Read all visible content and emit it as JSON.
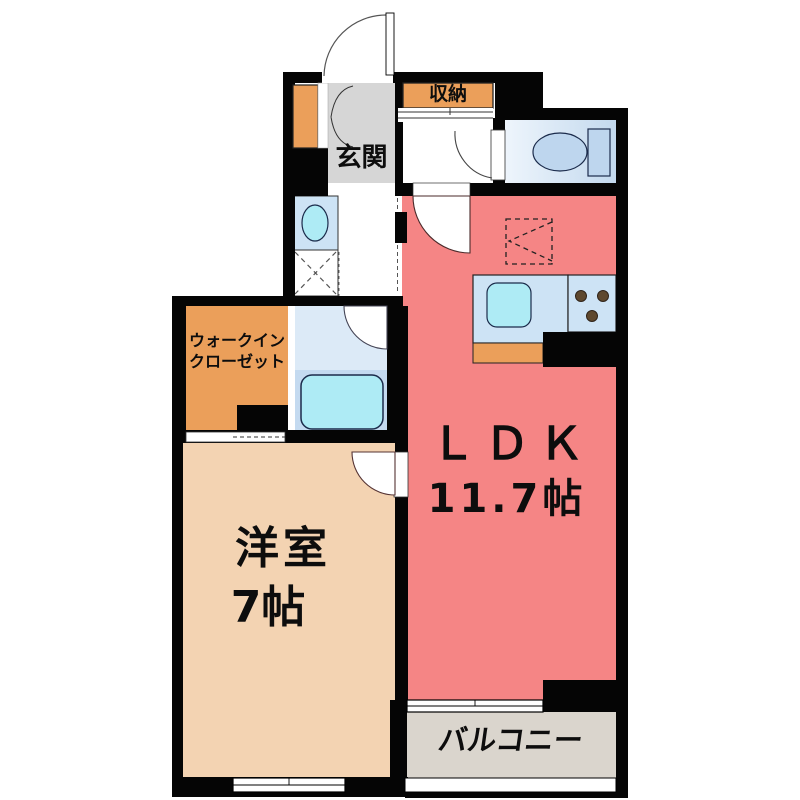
{
  "rooms": {
    "genkan_label": "玄関",
    "storage_label": "収納",
    "walkin_label_line1": "ウォークイン",
    "walkin_label_line2": "クローゼット",
    "ldk_label": "ＬＤＫ",
    "ldk_size": "11.7帖",
    "western_label": "洋室",
    "western_size": "7帖",
    "balcony_label": "バルコニー"
  },
  "colors": {
    "wall": "#050505",
    "ldk_fill": "#f58585",
    "western_fill": "#f3d3b2",
    "closet_fill": "#eb9f5a",
    "genkan_fill": "#d6d6d6",
    "balcony_fill": "#dad5cd",
    "counter_fill": "#cde3f5",
    "water_fill": "#aeebf5",
    "bath_upper_fill": "#dceaf7",
    "bath_lower_fill": "#c4daf0",
    "burner_fill": "#5e482e"
  }
}
